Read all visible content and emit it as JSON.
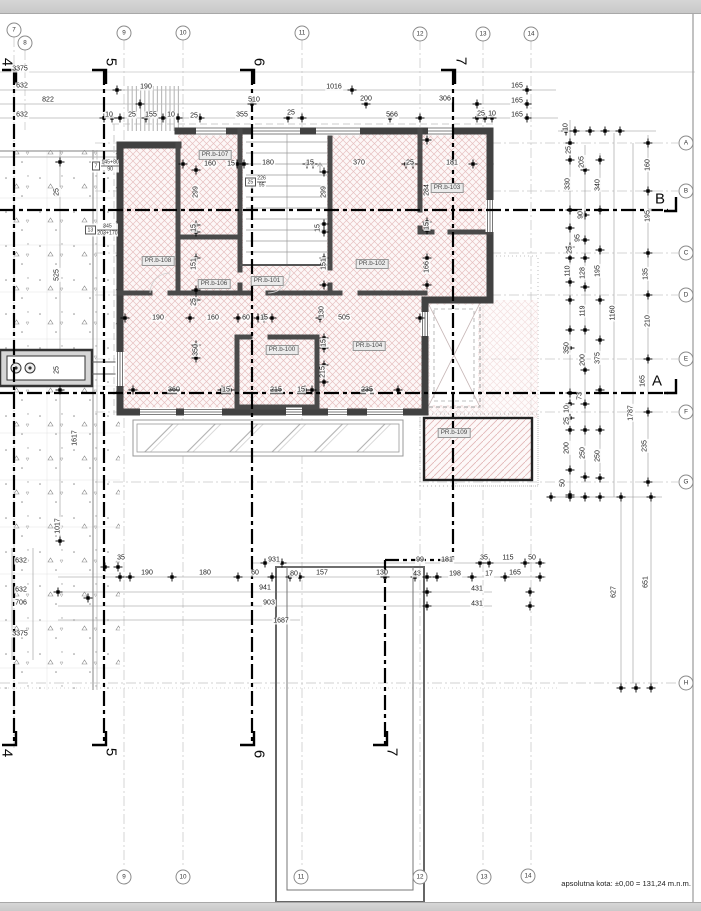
{
  "document": {
    "type": "architectural-floor-plan",
    "note_absolute_elevation": "apsolutna kota: ±0,00 = 131,24 m.n.m."
  },
  "colors": {
    "hatch_pink": "#e6c0c0",
    "wall": "#414141",
    "section_line": "#000000",
    "grid_line": "#c2c2c2",
    "paper": "#ffffff",
    "bar": "#d4d4d4"
  },
  "grid": {
    "top_bubbles": [
      {
        "label": "7",
        "x": 14,
        "y": 30
      },
      {
        "label": "8",
        "x": 25,
        "y": 43
      },
      {
        "label": "9",
        "x": 124,
        "y": 33
      },
      {
        "label": "10",
        "x": 183,
        "y": 33
      },
      {
        "label": "11",
        "x": 302,
        "y": 33
      },
      {
        "label": "12",
        "x": 420,
        "y": 34
      },
      {
        "label": "13",
        "x": 483,
        "y": 34
      },
      {
        "label": "14",
        "x": 531,
        "y": 34
      }
    ],
    "bottom_bubbles": [
      {
        "label": "9",
        "x": 124,
        "y": 877
      },
      {
        "label": "10",
        "x": 183,
        "y": 877
      },
      {
        "label": "11",
        "x": 301,
        "y": 877
      },
      {
        "label": "12",
        "x": 420,
        "y": 877
      },
      {
        "label": "13",
        "x": 484,
        "y": 877
      },
      {
        "label": "14",
        "x": 528,
        "y": 876
      }
    ],
    "row_bubbles": [
      {
        "label": "A",
        "x": 686,
        "y": 143
      },
      {
        "label": "B",
        "x": 686,
        "y": 191
      },
      {
        "label": "C",
        "x": 686,
        "y": 253
      },
      {
        "label": "D",
        "x": 686,
        "y": 295
      },
      {
        "label": "E",
        "x": 686,
        "y": 359
      },
      {
        "label": "F",
        "x": 686,
        "y": 412
      },
      {
        "label": "G",
        "x": 686,
        "y": 482
      },
      {
        "label": "H",
        "x": 686,
        "y": 683
      }
    ]
  },
  "sections": {
    "top": [
      {
        "label": "4",
        "x": 7,
        "y": 62
      },
      {
        "label": "5",
        "x": 111,
        "y": 62
      },
      {
        "label": "6",
        "x": 259,
        "y": 62
      },
      {
        "label": "7",
        "x": 461,
        "y": 61
      }
    ],
    "bottom": [
      {
        "label": "4",
        "x": 7,
        "y": 753
      },
      {
        "label": "5",
        "x": 111,
        "y": 752
      },
      {
        "label": "6",
        "x": 259,
        "y": 754
      },
      {
        "label": "7",
        "x": 392,
        "y": 752
      }
    ],
    "right": [
      {
        "label": "B",
        "x": 660,
        "y": 199
      },
      {
        "label": "A",
        "x": 657,
        "y": 381
      }
    ]
  },
  "rooms": [
    {
      "label": "PR.b-107",
      "x": 215,
      "y": 155
    },
    {
      "label": "PR.b-103",
      "x": 447,
      "y": 188
    },
    {
      "label": "PR.b-108",
      "x": 158,
      "y": 261
    },
    {
      "label": "PR.b-102",
      "x": 372,
      "y": 264
    },
    {
      "label": "PR.b-106",
      "x": 214,
      "y": 284
    },
    {
      "label": "PR.b-101",
      "x": 267,
      "y": 281
    },
    {
      "label": "PR.b-100",
      "x": 282,
      "y": 350
    },
    {
      "label": "PR.b-104",
      "x": 369,
      "y": 346
    },
    {
      "label": "PR.b-109",
      "x": 454,
      "y": 433
    }
  ],
  "tags": [
    {
      "box": "7",
      "top": "145+80",
      "bottom": "90",
      "x": 92,
      "y": 166
    },
    {
      "box": "13",
      "top": "345",
      "bottom": "203+170",
      "x": 85,
      "y": 230
    },
    {
      "box": "25",
      "top": "226",
      "bottom": "95",
      "x": 245,
      "y": 182
    }
  ],
  "dims": [
    [
      "3375",
      20,
      69
    ],
    [
      "632",
      22,
      86
    ],
    [
      "822",
      48,
      100
    ],
    [
      "632",
      22,
      115
    ],
    [
      "190",
      146,
      87
    ],
    [
      "1016",
      334,
      87
    ],
    [
      "510",
      254,
      100
    ],
    [
      "200",
      366,
      99
    ],
    [
      "306",
      445,
      99
    ],
    [
      "566",
      392,
      115
    ],
    [
      "165",
      517,
      86
    ],
    [
      "165",
      517,
      101
    ],
    [
      "165",
      517,
      115
    ],
    [
      "10",
      109,
      115
    ],
    [
      "25",
      132,
      115
    ],
    [
      "155",
      151,
      115
    ],
    [
      "10",
      171,
      115
    ],
    [
      "25",
      194,
      116
    ],
    [
      "355",
      242,
      115
    ],
    [
      "25",
      291,
      113
    ],
    [
      "25",
      481,
      114
    ],
    [
      "10",
      492,
      114
    ],
    [
      "10",
      566,
      127,
      1
    ],
    [
      "25",
      569,
      150,
      1
    ],
    [
      "205",
      582,
      162,
      1
    ],
    [
      "330",
      568,
      184,
      1
    ],
    [
      "340",
      598,
      185,
      1
    ],
    [
      "90",
      581,
      215,
      1
    ],
    [
      "95",
      578,
      238,
      1
    ],
    [
      "25",
      570,
      250,
      1
    ],
    [
      "110",
      568,
      271,
      1
    ],
    [
      "128",
      583,
      273,
      1
    ],
    [
      "195",
      598,
      271,
      1
    ],
    [
      "160",
      648,
      165,
      1
    ],
    [
      "195",
      648,
      216,
      1
    ],
    [
      "135",
      646,
      274,
      1
    ],
    [
      "119",
      583,
      311,
      1
    ],
    [
      "1160",
      613,
      313,
      1
    ],
    [
      "210",
      648,
      321,
      1
    ],
    [
      "350",
      567,
      348,
      1
    ],
    [
      "200",
      583,
      360,
      1
    ],
    [
      "375",
      598,
      358,
      1
    ],
    [
      "73",
      580,
      396,
      1
    ],
    [
      "165",
      643,
      381,
      1
    ],
    [
      "10",
      567,
      409,
      1
    ],
    [
      "25",
      567,
      421,
      1
    ],
    [
      "1787",
      631,
      413,
      1
    ],
    [
      "235",
      645,
      446,
      1
    ],
    [
      "200",
      567,
      448,
      1
    ],
    [
      "250",
      583,
      453,
      1
    ],
    [
      "250",
      598,
      456,
      1
    ],
    [
      "50",
      563,
      483,
      1
    ],
    [
      "627",
      614,
      592,
      1
    ],
    [
      "651",
      646,
      582,
      1
    ],
    [
      "525",
      57,
      275,
      1
    ],
    [
      "25",
      57,
      192,
      1
    ],
    [
      "25",
      57,
      370,
      1
    ],
    [
      "1617",
      75,
      438,
      1
    ],
    [
      "1017",
      58,
      526,
      1
    ],
    [
      "632",
      21,
      561
    ],
    [
      "632",
      21,
      590
    ],
    [
      "706",
      21,
      603
    ],
    [
      "3375",
      20,
      634
    ],
    [
      "35",
      121,
      558
    ],
    [
      "190",
      147,
      573
    ],
    [
      "180",
      205,
      573
    ],
    [
      "60",
      255,
      573
    ],
    [
      "931",
      274,
      560
    ],
    [
      "80",
      294,
      574
    ],
    [
      "157",
      322,
      573
    ],
    [
      "941",
      265,
      588
    ],
    [
      "903",
      269,
      603
    ],
    [
      "1687",
      281,
      621
    ],
    [
      "130",
      382,
      573
    ],
    [
      "43",
      417,
      574
    ],
    [
      "99",
      420,
      560
    ],
    [
      "181",
      447,
      560
    ],
    [
      "198",
      455,
      574
    ],
    [
      "35",
      484,
      558
    ],
    [
      "115",
      508,
      558
    ],
    [
      "50",
      532,
      558
    ],
    [
      "17",
      489,
      574
    ],
    [
      "165",
      515,
      573
    ],
    [
      "431",
      477,
      589
    ],
    [
      "431",
      477,
      604
    ],
    [
      "160",
      210,
      164
    ],
    [
      "15",
      231,
      164
    ],
    [
      "180",
      268,
      163
    ],
    [
      "15",
      310,
      163
    ],
    [
      "370",
      359,
      163
    ],
    [
      "25",
      410,
      163
    ],
    [
      "181",
      452,
      163
    ],
    [
      "299",
      196,
      192,
      1
    ],
    [
      "299",
      324,
      192,
      1
    ],
    [
      "284",
      427,
      190,
      1
    ],
    [
      "15",
      194,
      228,
      1
    ],
    [
      "15",
      318,
      228,
      1
    ],
    [
      "15",
      427,
      226,
      1
    ],
    [
      "151",
      194,
      264,
      1
    ],
    [
      "151",
      324,
      264,
      1
    ],
    [
      "166",
      427,
      267,
      1
    ],
    [
      "25",
      194,
      302,
      1
    ],
    [
      "130",
      322,
      312,
      1
    ],
    [
      "350",
      196,
      350,
      1
    ],
    [
      "15",
      324,
      343,
      1
    ],
    [
      "215",
      323,
      372,
      1
    ],
    [
      "190",
      158,
      318
    ],
    [
      "160",
      213,
      318
    ],
    [
      "60",
      246,
      318
    ],
    [
      "15",
      264,
      318
    ],
    [
      "505",
      344,
      318
    ],
    [
      "360",
      174,
      390,
      0,
      1
    ],
    [
      "15",
      226,
      390
    ],
    [
      "215",
      276,
      390,
      0,
      1
    ],
    [
      "15",
      301,
      390
    ],
    [
      "235",
      367,
      390,
      0,
      1
    ]
  ]
}
